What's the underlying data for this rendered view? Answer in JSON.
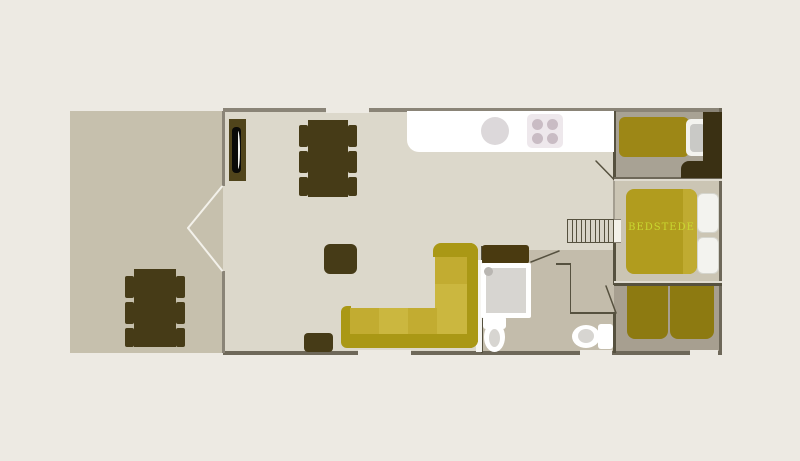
{
  "plan": {
    "bedstede_label": "BEDSTEDE"
  },
  "colors": {
    "background": "#edeae3",
    "terrace_floor": "#c6c0ad",
    "interior_floor": "#dcd8cb",
    "bath_floor": "#c3bcab",
    "bedroom_top_floor": "#a8a294",
    "bedstede_floor": "#cbc5b4",
    "bedroom_bottom_floor": "#a79f90",
    "wall_light": "#8a8477",
    "wall_mid": "#6e6859",
    "wall_dark": "#56513f",
    "wall_faint": "#a49e90",
    "separator_cream": "#e0dcd1",
    "furniture": "#463b17",
    "vanity": "#4a3a10",
    "wardrobe": "#3a3013",
    "sofa_frame": "#aa9815",
    "sofa_cushion_a": "#c2ac31",
    "sofa_cushion_b": "#cbb73f",
    "bed_top": "#9d8716",
    "bed_double": "#b19c1e",
    "bed_double_strip": "#c0ab31",
    "bed_bottom": "#8d7a11",
    "counter": "#ffffff",
    "sink": "#dcd8da",
    "stove": "#eee8ec",
    "burner": "#c9bcc4",
    "fixture_white": "#ffffff",
    "fixture_gray": "#d7d5d1",
    "pillow_white": "#f3f3ef",
    "pillow_gray": "#c9c9c6",
    "screen_black": "#0a0a08",
    "screen_glint": "#f2f2ef",
    "white_strip": "#f6f5f1",
    "stairs_bg": "#d8d4c8",
    "door_white": "#f3f1ea",
    "label": "#c9d830"
  }
}
